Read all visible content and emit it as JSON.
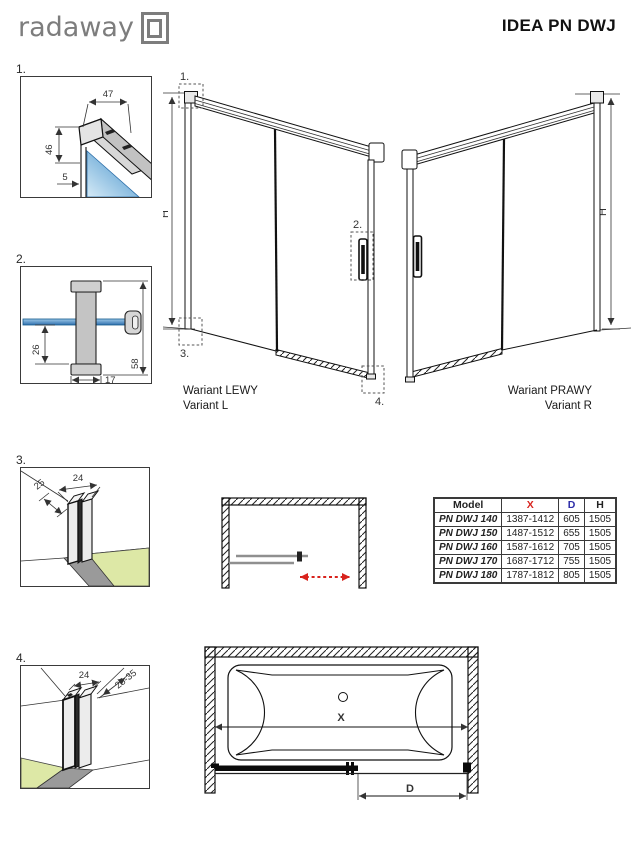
{
  "header": {
    "brand": "radaway",
    "title": "IDEA PN DWJ"
  },
  "details": {
    "d1": {
      "label": "1.",
      "dim_width": "47",
      "dim_height": "46",
      "dim_gap": "5"
    },
    "d2": {
      "label": "2.",
      "dim_offset": "26",
      "dim_width": "17",
      "dim_height": "58"
    },
    "d3": {
      "label": "3.",
      "dim_depth": "25",
      "dim_width": "24"
    },
    "d4": {
      "label": "4.",
      "dim_width": "24",
      "dim_range": "25-35"
    }
  },
  "doors": {
    "left": {
      "callout_1": "1.",
      "callout_2": "2.",
      "callout_3": "3.",
      "callout_4": "4.",
      "height_label": "H",
      "caption_line1": "Wariant LEWY",
      "caption_line2": "Variant L"
    },
    "right": {
      "height_label": "H",
      "caption_line1": "Wariant PRAWY",
      "caption_line2": "Variant R"
    }
  },
  "table": {
    "headers": {
      "model": "Model",
      "x": "X",
      "d": "D",
      "h": "H"
    },
    "rows": [
      {
        "model": "PN DWJ 140",
        "x": "1387-1412",
        "d": "605",
        "h": "1505"
      },
      {
        "model": "PN DWJ 150",
        "x": "1487-1512",
        "d": "655",
        "h": "1505"
      },
      {
        "model": "PN DWJ 160",
        "x": "1587-1612",
        "d": "705",
        "h": "1505"
      },
      {
        "model": "PN DWJ 170",
        "x": "1687-1712",
        "d": "755",
        "h": "1505"
      },
      {
        "model": "PN DWJ 180",
        "x": "1787-1812",
        "d": "805",
        "h": "1505"
      }
    ]
  },
  "tub_view": {
    "x_label": "X",
    "d_label": "D"
  },
  "colors": {
    "dim_red": "#d8231d",
    "dim_blue": "#2d2da8",
    "glass_blue": "#3f87c6",
    "floor_green": "#dde8a6",
    "profile_gray": "#c8c8c8",
    "logo_gray": "#7d7d7d"
  }
}
